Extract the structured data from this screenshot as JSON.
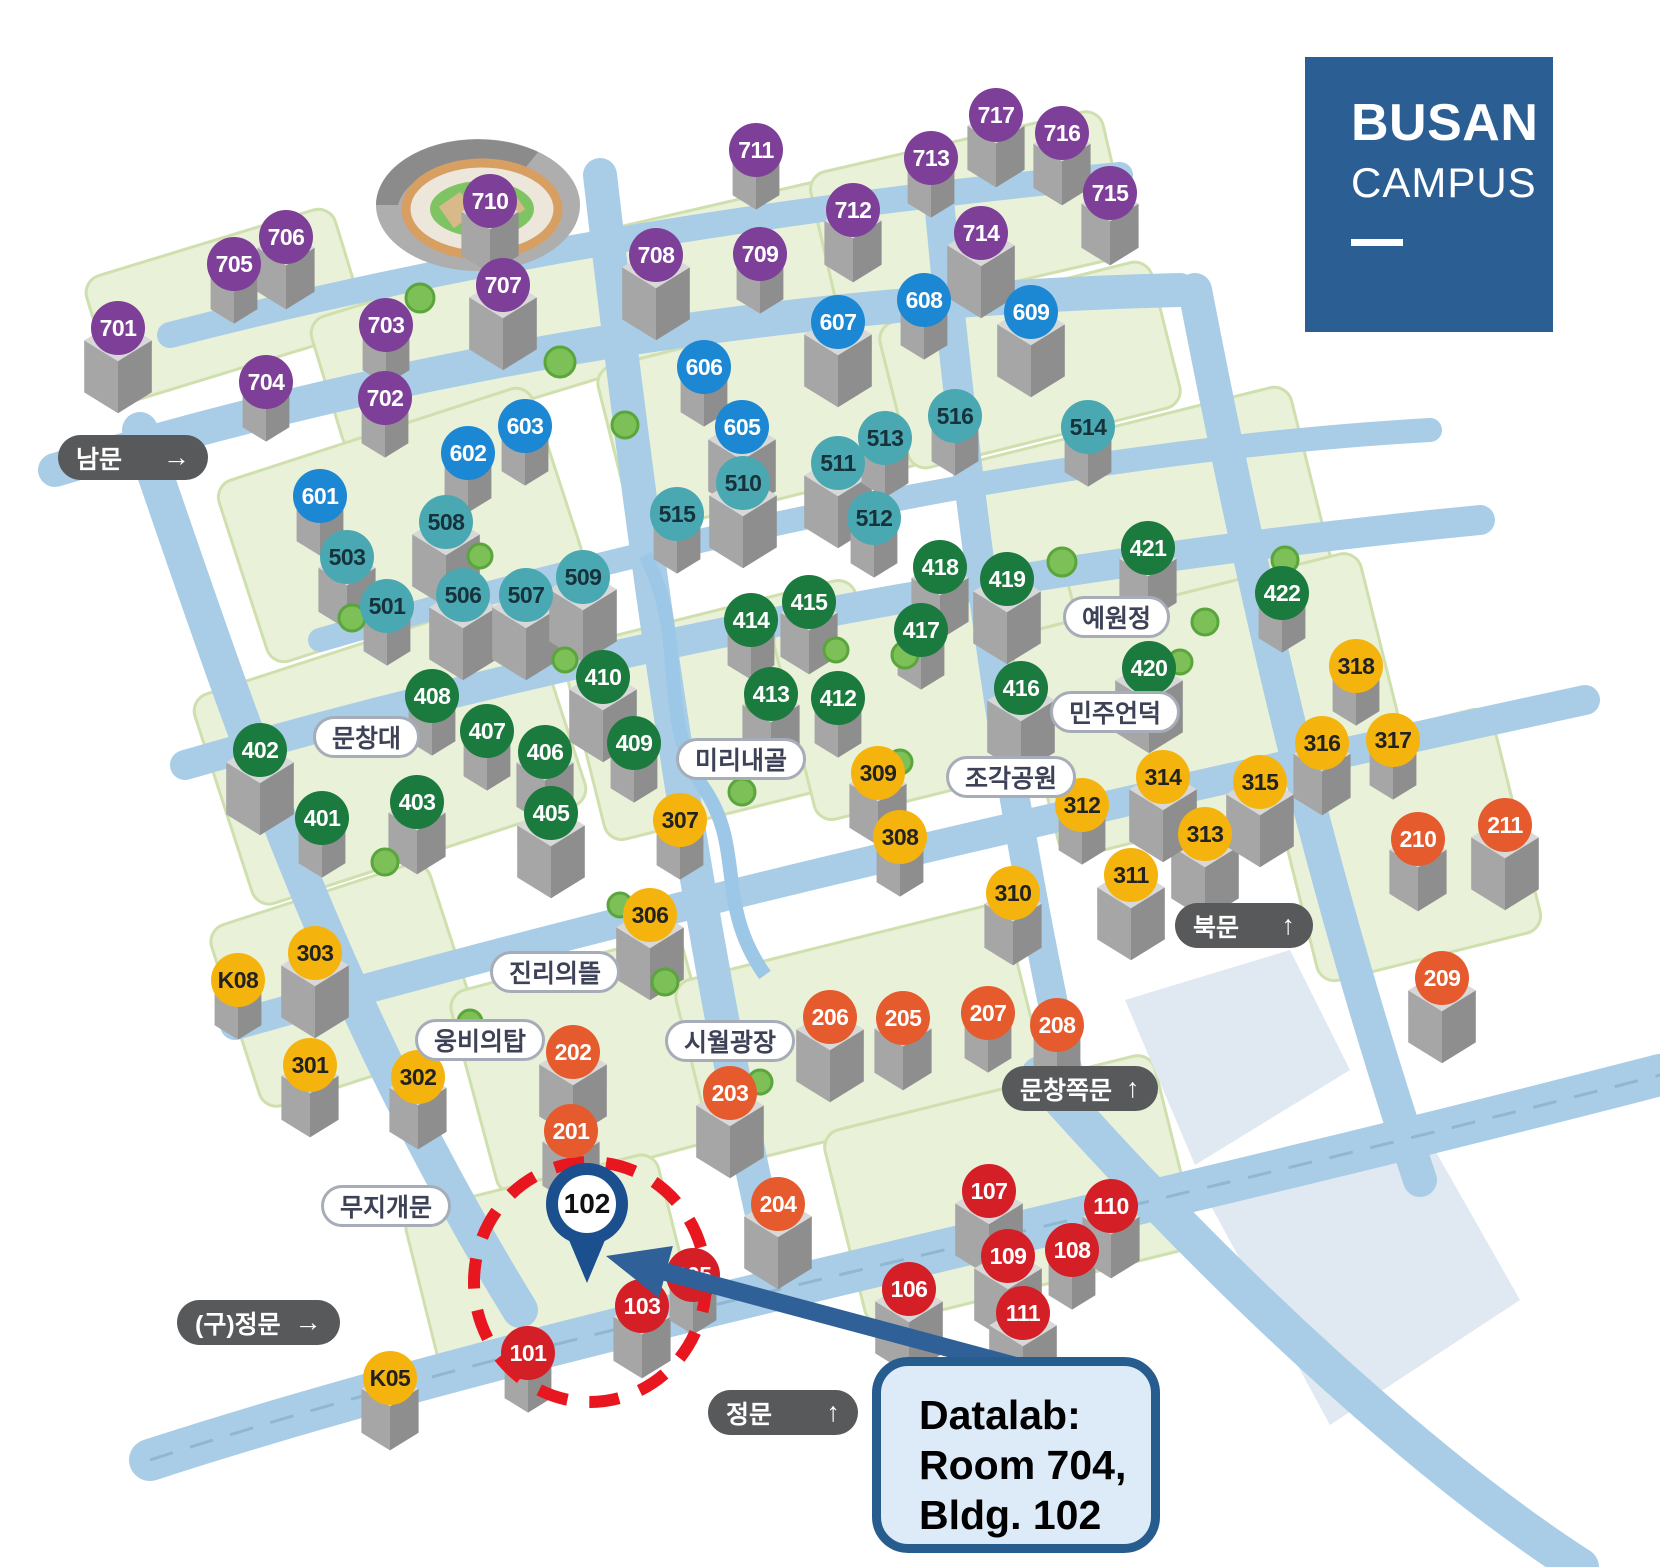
{
  "logo": {
    "title": "BUSAN",
    "subtitle": "CAMPUS"
  },
  "callout": {
    "line1": "Datalab:",
    "line2": "Room 704,",
    "line3": "Bldg. 102"
  },
  "pin": {
    "label": "102"
  },
  "colors": {
    "group_700s": "#7d3f98",
    "group_600s": "#1c87d3",
    "group_500s": "#4aa8b2",
    "group_400s": "#1b7a3d",
    "group_300s": "#f5b40d",
    "group_200s": "#e65b2d",
    "group_100s": "#d41f27",
    "road": "#a9cde6",
    "block": "#e9f1d9",
    "logo_blue": "#2b5f94",
    "callout_border": "#265c8e",
    "highlight_red": "#e8161e",
    "arrow_blue": "#2f6097",
    "pin_blue": "#1c4f8d",
    "gate_pill": "#58595b"
  },
  "markers": {
    "groups": [
      {
        "name": "buildings-700s",
        "fill": "#7d3f98",
        "text_color": "#ffffff",
        "items": [
          {
            "label": "701",
            "x": 118,
            "y": 328
          },
          {
            "label": "702",
            "x": 385,
            "y": 398
          },
          {
            "label": "703",
            "x": 386,
            "y": 325
          },
          {
            "label": "704",
            "x": 266,
            "y": 382
          },
          {
            "label": "705",
            "x": 234,
            "y": 264
          },
          {
            "label": "706",
            "x": 286,
            "y": 237
          },
          {
            "label": "707",
            "x": 503,
            "y": 285
          },
          {
            "label": "708",
            "x": 656,
            "y": 255
          },
          {
            "label": "709",
            "x": 760,
            "y": 254
          },
          {
            "label": "710",
            "x": 490,
            "y": 201
          },
          {
            "label": "711",
            "x": 756,
            "y": 150
          },
          {
            "label": "712",
            "x": 853,
            "y": 210
          },
          {
            "label": "713",
            "x": 931,
            "y": 158
          },
          {
            "label": "714",
            "x": 981,
            "y": 233
          },
          {
            "label": "715",
            "x": 1110,
            "y": 193
          },
          {
            "label": "716",
            "x": 1062,
            "y": 133
          },
          {
            "label": "717",
            "x": 996,
            "y": 115
          }
        ]
      },
      {
        "name": "buildings-600s",
        "fill": "#1c87d3",
        "text_color": "#ffffff",
        "items": [
          {
            "label": "601",
            "x": 320,
            "y": 496
          },
          {
            "label": "602",
            "x": 468,
            "y": 453
          },
          {
            "label": "603",
            "x": 525,
            "y": 426
          },
          {
            "label": "605",
            "x": 742,
            "y": 427
          },
          {
            "label": "606",
            "x": 704,
            "y": 367
          },
          {
            "label": "607",
            "x": 838,
            "y": 322
          },
          {
            "label": "608",
            "x": 924,
            "y": 300
          },
          {
            "label": "609",
            "x": 1031,
            "y": 312
          }
        ]
      },
      {
        "name": "buildings-500s",
        "fill": "#4aa8b2",
        "text_color": "#16323a",
        "items": [
          {
            "label": "501",
            "x": 387,
            "y": 606
          },
          {
            "label": "503",
            "x": 347,
            "y": 557
          },
          {
            "label": "506",
            "x": 463,
            "y": 595
          },
          {
            "label": "507",
            "x": 526,
            "y": 595
          },
          {
            "label": "508",
            "x": 446,
            "y": 522
          },
          {
            "label": "509",
            "x": 583,
            "y": 577
          },
          {
            "label": "510",
            "x": 743,
            "y": 483
          },
          {
            "label": "511",
            "x": 838,
            "y": 463
          },
          {
            "label": "512",
            "x": 874,
            "y": 518
          },
          {
            "label": "513",
            "x": 885,
            "y": 438
          },
          {
            "label": "514",
            "x": 1088,
            "y": 427
          },
          {
            "label": "515",
            "x": 677,
            "y": 514
          },
          {
            "label": "516",
            "x": 955,
            "y": 416
          }
        ]
      },
      {
        "name": "buildings-400s",
        "fill": "#1b7a3d",
        "text_color": "#ffffff",
        "items": [
          {
            "label": "401",
            "x": 322,
            "y": 818
          },
          {
            "label": "402",
            "x": 260,
            "y": 750
          },
          {
            "label": "403",
            "x": 417,
            "y": 802
          },
          {
            "label": "405",
            "x": 551,
            "y": 813
          },
          {
            "label": "406",
            "x": 545,
            "y": 752
          },
          {
            "label": "407",
            "x": 487,
            "y": 731
          },
          {
            "label": "408",
            "x": 432,
            "y": 696
          },
          {
            "label": "409",
            "x": 634,
            "y": 743
          },
          {
            "label": "410",
            "x": 603,
            "y": 677
          },
          {
            "label": "412",
            "x": 838,
            "y": 698
          },
          {
            "label": "413",
            "x": 771,
            "y": 694
          },
          {
            "label": "414",
            "x": 751,
            "y": 620
          },
          {
            "label": "415",
            "x": 809,
            "y": 602
          },
          {
            "label": "416",
            "x": 1021,
            "y": 688
          },
          {
            "label": "417",
            "x": 921,
            "y": 630
          },
          {
            "label": "418",
            "x": 940,
            "y": 567
          },
          {
            "label": "419",
            "x": 1007,
            "y": 579
          },
          {
            "label": "420",
            "x": 1149,
            "y": 668
          },
          {
            "label": "421",
            "x": 1148,
            "y": 548
          },
          {
            "label": "422",
            "x": 1282,
            "y": 593
          }
        ]
      },
      {
        "name": "buildings-300s",
        "fill": "#f5b40d",
        "text_color": "#222222",
        "items": [
          {
            "label": "301",
            "x": 310,
            "y": 1065
          },
          {
            "label": "302",
            "x": 418,
            "y": 1077
          },
          {
            "label": "303",
            "x": 315,
            "y": 953
          },
          {
            "label": "306",
            "x": 650,
            "y": 915
          },
          {
            "label": "307",
            "x": 680,
            "y": 820
          },
          {
            "label": "308",
            "x": 900,
            "y": 837
          },
          {
            "label": "309",
            "x": 878,
            "y": 773
          },
          {
            "label": "310",
            "x": 1013,
            "y": 893
          },
          {
            "label": "311",
            "x": 1131,
            "y": 875
          },
          {
            "label": "312",
            "x": 1082,
            "y": 805
          },
          {
            "label": "313",
            "x": 1205,
            "y": 834
          },
          {
            "label": "314",
            "x": 1163,
            "y": 777
          },
          {
            "label": "315",
            "x": 1260,
            "y": 782
          },
          {
            "label": "316",
            "x": 1322,
            "y": 743
          },
          {
            "label": "317",
            "x": 1393,
            "y": 740
          },
          {
            "label": "318",
            "x": 1356,
            "y": 666
          },
          {
            "label": "K08",
            "x": 238,
            "y": 980
          },
          {
            "label": "K05",
            "x": 390,
            "y": 1378
          }
        ]
      },
      {
        "name": "buildings-200s",
        "fill": "#e65b2d",
        "text_color": "#ffffff",
        "items": [
          {
            "label": "201",
            "x": 571,
            "y": 1131
          },
          {
            "label": "202",
            "x": 573,
            "y": 1052
          },
          {
            "label": "203",
            "x": 730,
            "y": 1093
          },
          {
            "label": "204",
            "x": 778,
            "y": 1204
          },
          {
            "label": "205",
            "x": 903,
            "y": 1018
          },
          {
            "label": "206",
            "x": 830,
            "y": 1017
          },
          {
            "label": "207",
            "x": 988,
            "y": 1013
          },
          {
            "label": "208",
            "x": 1057,
            "y": 1025
          },
          {
            "label": "209",
            "x": 1442,
            "y": 978
          },
          {
            "label": "210",
            "x": 1418,
            "y": 839
          },
          {
            "label": "211",
            "x": 1505,
            "y": 825
          }
        ]
      },
      {
        "name": "buildings-100s",
        "fill": "#d41f27",
        "text_color": "#ffffff",
        "items": [
          {
            "label": "101",
            "x": 528,
            "y": 1353
          },
          {
            "label": "103",
            "x": 642,
            "y": 1306
          },
          {
            "label": "105",
            "x": 693,
            "y": 1275
          },
          {
            "label": "106",
            "x": 909,
            "y": 1289
          },
          {
            "label": "107",
            "x": 989,
            "y": 1191
          },
          {
            "label": "108",
            "x": 1072,
            "y": 1250
          },
          {
            "label": "109",
            "x": 1008,
            "y": 1256
          },
          {
            "label": "110",
            "x": 1111,
            "y": 1206
          },
          {
            "label": "111",
            "x": 1023,
            "y": 1313
          }
        ]
      }
    ]
  },
  "gates": [
    {
      "label": "남문",
      "arrow": "→",
      "x": 58,
      "y": 435,
      "w": 150
    },
    {
      "label": "(구)정문",
      "arrow": "→",
      "x": 177,
      "y": 1300,
      "w": 150
    },
    {
      "label": "북문",
      "arrow": "↑",
      "x": 1175,
      "y": 903,
      "w": 138
    },
    {
      "label": "문창쪽문",
      "arrow": "↑",
      "x": 1002,
      "y": 1066,
      "w": 152
    },
    {
      "label": "정문",
      "arrow": "↑",
      "x": 708,
      "y": 1390,
      "w": 150
    }
  ],
  "places": [
    {
      "label": "문창대",
      "x": 313,
      "y": 716
    },
    {
      "label": "미리내골",
      "x": 676,
      "y": 738
    },
    {
      "label": "예원정",
      "x": 1063,
      "y": 596
    },
    {
      "label": "민주언덕",
      "x": 1050,
      "y": 691
    },
    {
      "label": "조각공원",
      "x": 946,
      "y": 756
    },
    {
      "label": "진리의뜰",
      "x": 490,
      "y": 951
    },
    {
      "label": "웅비의탑",
      "x": 415,
      "y": 1019
    },
    {
      "label": "무지개문",
      "x": 321,
      "y": 1185
    },
    {
      "label": "시월광장",
      "x": 665,
      "y": 1020
    }
  ]
}
